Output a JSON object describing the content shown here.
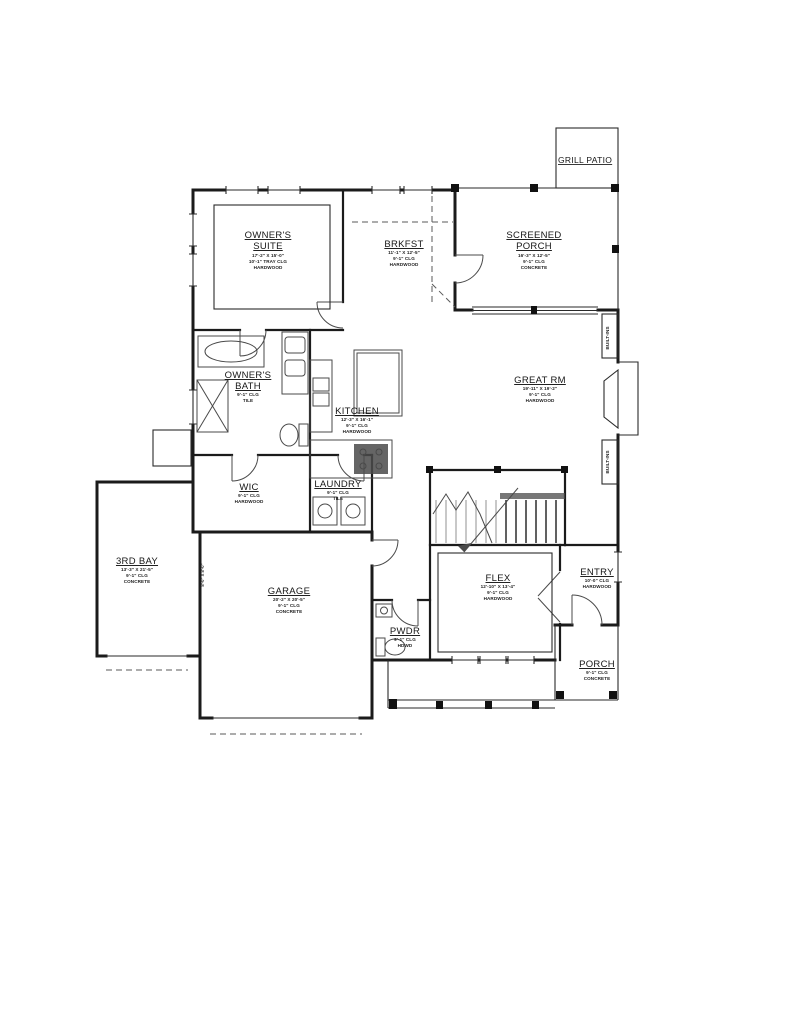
{
  "drawing": {
    "labels": {
      "built_ins_top": "BUILT-INS",
      "built_ins_bottom": "BUILT-INS",
      "bay_door_size": "8'-0\" X 8'-0\""
    }
  },
  "rooms": {
    "grill_patio": {
      "name": "GRILL PATIO"
    },
    "owners_suite": {
      "name1": "OWNER'S",
      "name2": "SUITE",
      "dims": "17'-2\" X 15'-0\"",
      "clg": "10'-1\" TRAY CLG",
      "floor": "HARDWOOD"
    },
    "brkfst": {
      "name": "BRKFST",
      "dims": "11'-1\" X 12'-5\"",
      "clg": "9'-1\" CLG",
      "floor": "HARDWOOD"
    },
    "screened_porch": {
      "name1": "SCREENED",
      "name2": "PORCH",
      "dims": "16'-3\" X 12'-5\"",
      "clg": "9'-1\" CLG",
      "floor": "CONCRETE"
    },
    "owners_bath": {
      "name1": "OWNER'S",
      "name2": "BATH",
      "clg": "9'-1\" CLG",
      "floor": "TILE"
    },
    "great_rm": {
      "name": "GREAT RM",
      "dims": "19'-11\" X 19'-2\"",
      "clg": "9'-1\" CLG",
      "floor": "HARDWOOD"
    },
    "kitchen": {
      "name": "KITCHEN",
      "dims": "12'-3\" X 16'-1\"",
      "clg": "9'-1\" CLG",
      "floor": "HARDWOOD"
    },
    "wic": {
      "name": "WIC",
      "clg": "9'-1\" CLG",
      "floor": "HARDWOOD"
    },
    "laundry": {
      "name": "LAUNDRY",
      "clg": "9'-1\" CLG",
      "floor": "TILE"
    },
    "third_bay": {
      "name": "3RD BAY",
      "dims": "13'-3\" X 21'-5\"",
      "clg": "9'-1\" CLG",
      "floor": "CONCRETE"
    },
    "garage": {
      "name": "GARAGE",
      "dims": "20'-2\" X 20'-5\"",
      "clg": "9'-1\" CLG",
      "floor": "CONCRETE"
    },
    "flex": {
      "name": "FLEX",
      "dims": "12'-10\" X 13'-4\"",
      "clg": "9'-1\" CLG",
      "floor": "HARDWOOD"
    },
    "entry": {
      "name": "ENTRY",
      "clg": "10'-0\" CLG",
      "floor": "HARDWOOD"
    },
    "pwdr": {
      "name": "PWDR",
      "clg": "9'-1\" CLG",
      "floor": "HDWD"
    },
    "porch": {
      "name": "PORCH",
      "clg": "9'-1\" CLG",
      "floor": "CONCRETE"
    }
  },
  "colors": {
    "wall": "#1b1b1b",
    "fixture": "#4a4a4a",
    "tread_light": "#b0b0b0"
  }
}
